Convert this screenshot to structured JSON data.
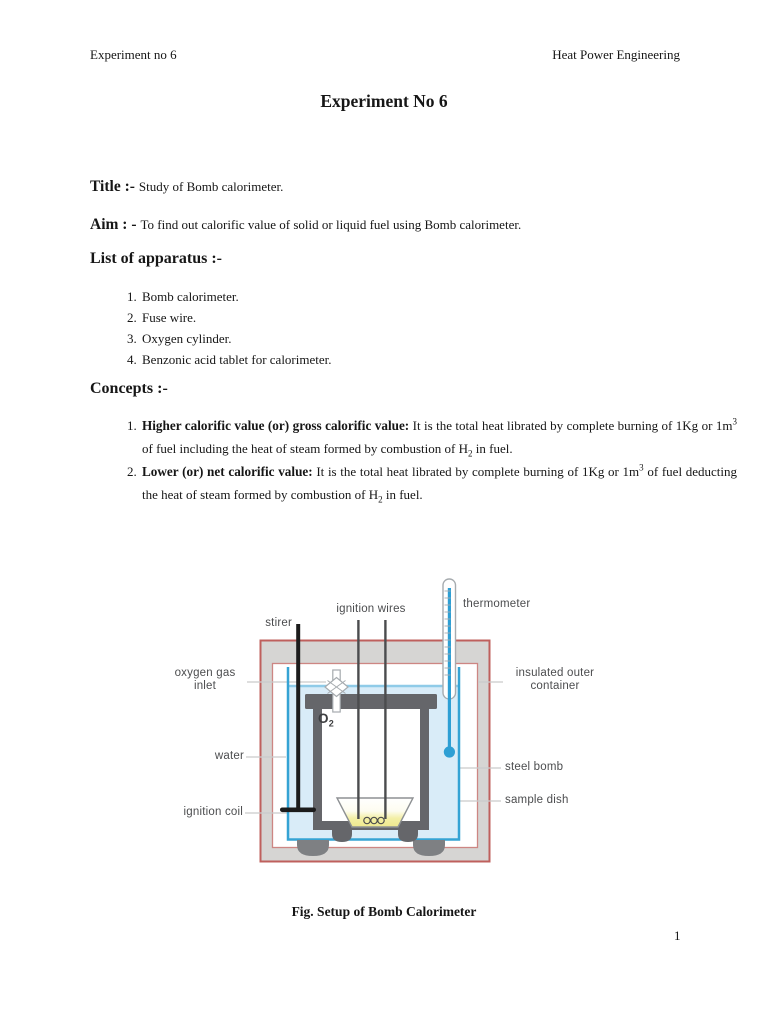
{
  "page": {
    "header_left": "Experiment no 6",
    "header_right": "Heat Power Engineering",
    "title": "Experiment No 6",
    "page_number": "1"
  },
  "sections": {
    "title_label": "Title :-",
    "title_text": "Study of Bomb calorimeter.",
    "aim_label": "Aim : -",
    "aim_text": "To find out calorific value of solid or liquid fuel using Bomb calorimeter.",
    "apparatus_heading": "List of apparatus :-",
    "apparatus_items": [
      "Bomb calorimeter.",
      "Fuse wire.",
      "Oxygen cylinder.",
      "Benzonic acid tablet for calorimeter."
    ],
    "concepts_heading": "Concepts :-",
    "concepts": [
      {
        "bold": "Higher calorific value (or) gross calorific value:",
        "t1": " It is the total heat librated by complete burning of 1Kg or 1m",
        "sup": "3",
        "t2": " of fuel including the heat of steam formed by combustion of H",
        "sub": "2",
        "t3": " in fuel."
      },
      {
        "bold": "Lower (or) net calorific value:",
        "t1": " It is the total heat librated by complete burning of 1Kg or 1m",
        "sup": "3",
        "t2": " of fuel deducting the heat of steam formed by combustion of H",
        "sub": "2",
        "t3": " in fuel."
      }
    ]
  },
  "figure": {
    "caption": "Fig. Setup of Bomb Calorimeter",
    "labels": {
      "stirer": "stirer",
      "ignition_wires": "ignition wires",
      "thermometer": "thermometer",
      "oxygen_gas_inlet": "oxygen gas inlet",
      "insulated_outer_container": "insulated outer container",
      "water": "water",
      "steel_bomb": "steel bomb",
      "ignition_coil": "ignition coil",
      "sample_dish": "sample dish",
      "o2_main": "O",
      "o2_sub": "2"
    },
    "colors": {
      "container_outline": "#bf605d",
      "insulation_gray": "#d6d5d3",
      "water_fill": "#d9ecf8",
      "vessel_outline": "#35a3d4",
      "steel_gray": "#65666a",
      "dish_yellow": "#efe98e",
      "thermometer_blue": "#2e9fd4",
      "label_text": "#4c4d4f"
    }
  }
}
